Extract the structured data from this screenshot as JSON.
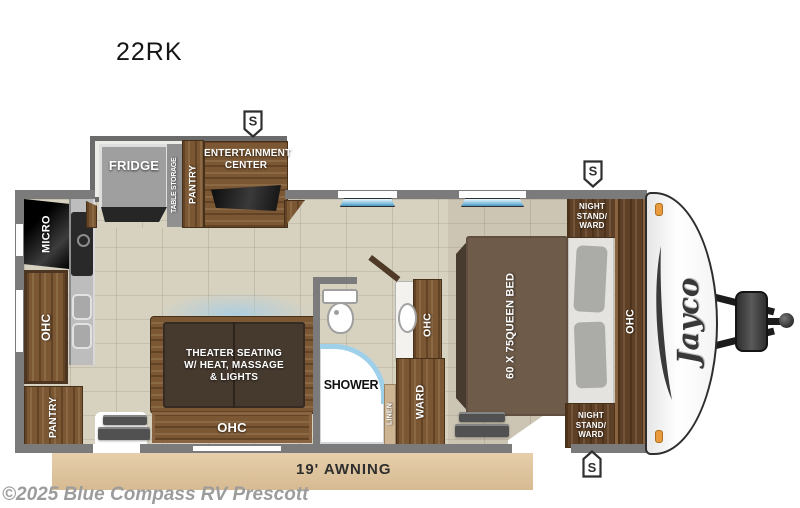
{
  "title": "22RK",
  "watermark": "©2025 Blue Compass RV Prescott",
  "awning_label": "19' AWNING",
  "brand": "Jayco",
  "speaker_symbol": "S",
  "slide_out": {
    "fridge": "FRIDGE",
    "table_storage": "TABLE STORAGE",
    "pantry": "PANTRY",
    "entertainment_lines": [
      "ENTERTAINMENT",
      "CENTER"
    ]
  },
  "kitchen": {
    "micro": "MICRO",
    "ohc": "OHC",
    "pantry": "PANTRY"
  },
  "living": {
    "theater_lines": [
      "THEATER SEATING",
      "W/ HEAT, MASSAGE",
      "& LIGHTS"
    ],
    "ohc": "OHC"
  },
  "bathroom": {
    "shower": "SHOWER",
    "ohc": "OHC",
    "linen": "LINEN",
    "ward": "WARD"
  },
  "bedroom": {
    "bed_lines": [
      "60 X 75",
      "QUEEN BED"
    ],
    "night_stand_lines": [
      "NIGHT",
      "STAND/",
      "WARD"
    ],
    "ohc": "OHC"
  },
  "colors": {
    "wood": "#7b5733",
    "wall": "#7b7b7b",
    "floor": "#d7d2c0",
    "awning": "#ddc29e",
    "window_blue": "#79bade",
    "marker_orange": "#e89a3c"
  }
}
